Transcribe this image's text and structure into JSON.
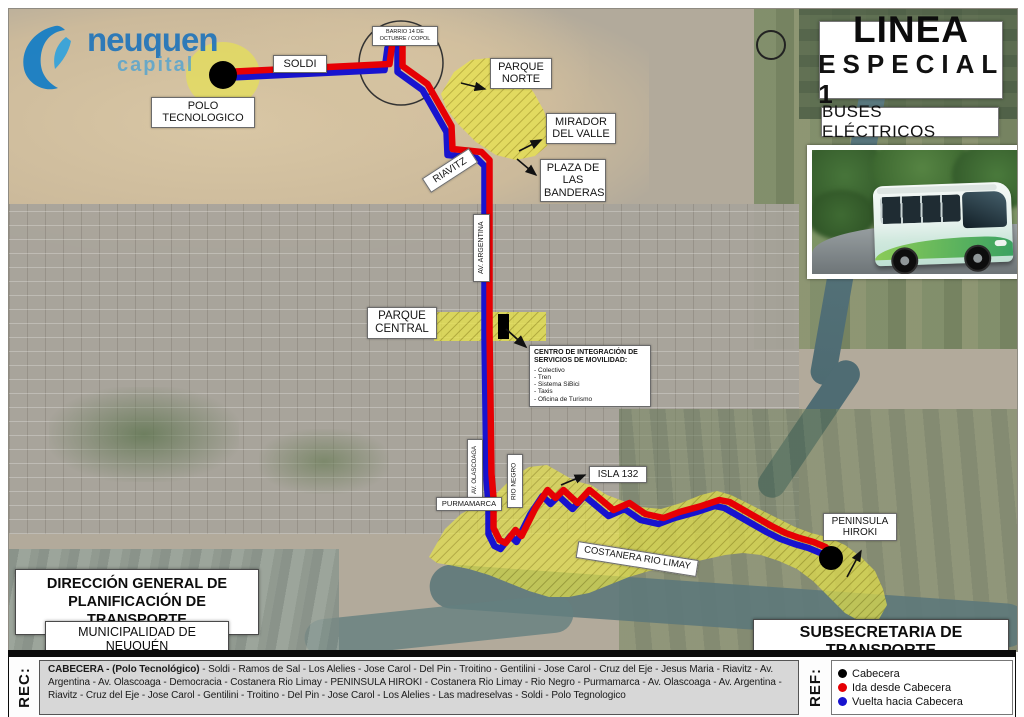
{
  "logo": {
    "name": "neuquen",
    "tagline": "capital"
  },
  "title_block": {
    "line1": "LINEA",
    "line2": "ESPECIAL 1",
    "subtitle": "BUSES ELÉCTRICOS"
  },
  "map_labels": {
    "soldi": "SOLDI",
    "polo_tecnologico": "POLO TECNOLOGICO",
    "barrio_circle": "BARRIO 14 DE OCTUBRE / COPOL",
    "parque_norte": "PARQUE NORTE",
    "mirador_del_valle": "MIRADOR DEL VALLE",
    "plaza_banderas": "PLAZA DE LAS BANDERAS",
    "riavitz": "RIAVITZ",
    "av_argentina": "AV. ARGENTINA",
    "parque_central": "PARQUE CENTRAL",
    "cisem_title": "CENTRO DE INTEGRACIÓN DE SERVICIOS DE MOVILIDAD:",
    "cisem_items": [
      "- Colectivo",
      "- Tren",
      "- Sistema SiBici",
      "- Taxis",
      "- Oficina de Turismo"
    ],
    "av_olascoaga": "AV. OLASCOAGA",
    "rio_negro": "RIO NEGRO",
    "purmamarca": "PURMAMARCA",
    "isla_132": "ISLA 132",
    "costanera": "COSTANERA RIO LIMAY",
    "peninsula_hiroki": "PENINSULA HIROKI"
  },
  "credit_boxes": {
    "direccion": "DIRECCIÓN GENERAL DE PLANIFICACIÓN DE TRANSPORTE",
    "municipalidad": "MUNICIPALIDAD DE NEUQUÉN",
    "subsecretaria": "SUBSECRETARIA DE TRANSPORTE"
  },
  "rec": {
    "label": "REC:",
    "bold": "CABECERA - (Polo Tecnológico)",
    "rest": " - Soldi - Ramos de Sal - Los Alelies - Jose Carol - Del Pin - Troitino - Gentilini - Jose Carol - Cruz del Eje - Jesus Maria - Riavitz - Av. Argentina - Av. Olascoaga - Democracia - Costanera Rio Limay - PENINSULA HIROKI - Costanera Rio Limay - Rio Negro - Purmamarca - Av. Olascoaga - Av. Argentina - Riavitz - Cruz del Eje - Jose Carol - Gentilini - Troitino - Del Pin - Jose Carol - Los Alelies - Las madreselvas - Soldi - Polo Tegnologico"
  },
  "ref": {
    "label": "REF:",
    "items": [
      {
        "icon": "black-dot-icon",
        "label": "Cabecera",
        "color": "#000000"
      },
      {
        "icon": "red-dot-icon",
        "label": "Ida desde Cabecera",
        "color": "#e60004"
      },
      {
        "icon": "blue-dot-icon",
        "label": "Vuelta hacia Cabecera",
        "color": "#1813cf"
      }
    ]
  },
  "colors": {
    "ida_route": "#e60004",
    "vuelta_route": "#1813cf",
    "highlight_area": "#e9e548",
    "hatch_line": "#b3ab1e"
  }
}
